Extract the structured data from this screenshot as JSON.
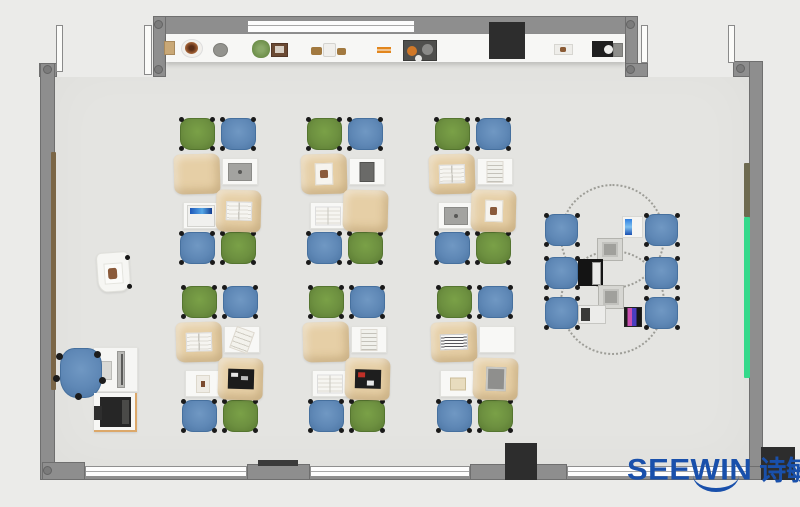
{
  "page": {
    "background": "#ebebe9",
    "width": 800,
    "height": 507
  },
  "logo": {
    "latin": "SEEWIN",
    "cjk": "诗敏",
    "color": "#1950ab"
  },
  "palette": {
    "floor": "#e4e4e1",
    "wall": "#8e8e8e",
    "window": "#fdfdfd",
    "counter": "#f7f7f5",
    "desk_tan": "#e6cfa6",
    "desk_white": "#f8f8f6",
    "chair_green": "#6d9040",
    "chair_blue": "#5f88b6",
    "column_black": "#2d2d2d",
    "board_green": "#35d98b",
    "board_brown": "#7b6647",
    "board_olive": "#6e6a50",
    "logo_blue": "#1950ab"
  },
  "room": {
    "floor": {
      "x": 47,
      "y": 60,
      "w": 706,
      "h": 410
    },
    "outside_patches": [
      {
        "x": 0,
        "y": 0,
        "w": 153,
        "h": 77
      },
      {
        "x": 638,
        "y": 0,
        "w": 162,
        "h": 77
      }
    ],
    "walls": [
      {
        "name": "top-wall",
        "x": 153,
        "y": 16,
        "w": 485,
        "h": 19
      },
      {
        "name": "top-wall-left-post",
        "x": 153,
        "y": 16,
        "w": 13,
        "h": 61
      },
      {
        "name": "top-wall-right-post",
        "x": 625,
        "y": 16,
        "w": 13,
        "h": 61
      },
      {
        "name": "top-right-door-sill",
        "x": 625,
        "y": 63,
        "w": 23,
        "h": 14
      },
      {
        "name": "left-wall-door-stub",
        "x": 39,
        "y": 63,
        "w": 18,
        "h": 14
      },
      {
        "name": "left-wall",
        "x": 40,
        "y": 63,
        "w": 15,
        "h": 417
      },
      {
        "name": "top-right-corner-wall",
        "x": 733,
        "y": 61,
        "w": 30,
        "h": 16
      },
      {
        "name": "right-wall",
        "x": 749,
        "y": 61,
        "w": 14,
        "h": 419
      },
      {
        "name": "bottom-wall",
        "x": 42,
        "y": 466,
        "w": 721,
        "h": 14
      },
      {
        "name": "bottom-left-corner-wall",
        "x": 42,
        "y": 462,
        "w": 43,
        "h": 18
      },
      {
        "name": "bottom-wall-segment-1",
        "x": 247,
        "y": 464,
        "w": 63,
        "h": 16
      },
      {
        "name": "bottom-wall-segment-2",
        "x": 470,
        "y": 464,
        "w": 97,
        "h": 16
      }
    ],
    "corner_dots": [
      [
        47,
        69
      ],
      [
        158,
        24
      ],
      [
        158,
        69
      ],
      [
        630,
        24
      ],
      [
        630,
        69
      ],
      [
        740,
        68
      ],
      [
        47,
        470
      ]
    ],
    "windows": [
      {
        "name": "top-window",
        "x": 247,
        "y": 20,
        "w": 168,
        "h": 13
      },
      {
        "name": "bottom-window-1",
        "x": 85,
        "y": 466,
        "w": 162,
        "h": 11
      },
      {
        "name": "bottom-window-2",
        "x": 310,
        "y": 466,
        "w": 160,
        "h": 11
      },
      {
        "name": "bottom-window-3",
        "x": 567,
        "y": 466,
        "w": 182,
        "h": 11
      }
    ],
    "doors": [
      {
        "name": "door-leaf-top-left-1",
        "x": 56,
        "y": 25,
        "w": 7,
        "h": 47
      },
      {
        "name": "door-leaf-top-left-2",
        "x": 144,
        "y": 25,
        "w": 8,
        "h": 50
      },
      {
        "name": "door-leaf-top-right-1",
        "x": 641,
        "y": 25,
        "w": 7,
        "h": 38
      },
      {
        "name": "door-leaf-top-right-2",
        "x": 728,
        "y": 25,
        "w": 7,
        "h": 38
      }
    ],
    "columns": [
      {
        "name": "pillar-top",
        "x": 489,
        "y": 22,
        "w": 36,
        "h": 37
      },
      {
        "name": "pillar-bottom",
        "x": 505,
        "y": 443,
        "w": 32,
        "h": 37
      },
      {
        "name": "pillar-bottom-right",
        "x": 761,
        "y": 447,
        "w": 34,
        "h": 33
      }
    ],
    "vent_bar": {
      "x": 258,
      "y": 460,
      "w": 40,
      "h": 6
    },
    "boards": [
      {
        "name": "left-wall-board",
        "x": 51,
        "y": 152,
        "w": 5,
        "h": 238,
        "color": "#7b6647"
      },
      {
        "name": "right-wall-board-olive",
        "x": 744,
        "y": 163,
        "w": 6,
        "h": 54,
        "color": "#6e6a50"
      },
      {
        "name": "right-wall-board-green",
        "x": 744,
        "y": 217,
        "w": 6,
        "h": 161,
        "color": "#35d98b"
      }
    ],
    "counter": {
      "x": 166,
      "y": 34,
      "w": 459,
      "h": 28
    },
    "counter_items": [
      {
        "type": "box-tan",
        "name": "decor-box",
        "x": 164,
        "y": 41,
        "w": 11,
        "h": 14
      },
      {
        "type": "plate-pot",
        "name": "decor-pot",
        "x": 181,
        "y": 39,
        "w": 22,
        "h": 19
      },
      {
        "type": "bowl-gray",
        "name": "decor-bowl",
        "x": 213,
        "y": 43,
        "w": 15,
        "h": 14
      },
      {
        "type": "plant-green",
        "name": "decor-plant",
        "x": 252,
        "y": 40,
        "w": 18,
        "h": 18
      },
      {
        "type": "frame-photo",
        "name": "decor-photo-frame",
        "x": 271,
        "y": 43,
        "w": 17,
        "h": 14
      },
      {
        "type": "wood",
        "name": "decor-wood-piece",
        "x": 311,
        "y": 47,
        "w": 11,
        "h": 8
      },
      {
        "type": "bottle",
        "name": "decor-bottle",
        "x": 323,
        "y": 43,
        "w": 13,
        "h": 14
      },
      {
        "type": "wood",
        "name": "decor-wood-piece",
        "x": 337,
        "y": 48,
        "w": 9,
        "h": 7
      },
      {
        "type": "sticks",
        "name": "decor-sticks",
        "x": 377,
        "y": 47,
        "w": 14,
        "h": 6
      },
      {
        "type": "tray-dark",
        "name": "decor-art-tray",
        "x": 403,
        "y": 40,
        "w": 34,
        "h": 21
      },
      {
        "type": "tray-white",
        "name": "decor-small-tray",
        "x": 554,
        "y": 44,
        "w": 19,
        "h": 11
      },
      {
        "type": "device-black",
        "name": "decor-device",
        "x": 592,
        "y": 41,
        "w": 21,
        "h": 16
      },
      {
        "type": "device-gray",
        "name": "decor-device-side",
        "x": 613,
        "y": 43,
        "w": 10,
        "h": 14
      }
    ]
  },
  "teacher_area": {
    "easel": {
      "x": 97,
      "y": 252,
      "w": 33,
      "h": 40
    },
    "desk": {
      "x": 93,
      "y": 347,
      "w": 45,
      "h": 45
    },
    "monitor": {
      "x": 117,
      "y": 351,
      "w": 8,
      "h": 37
    },
    "keyboard": {
      "x": 101,
      "y": 361,
      "w": 11,
      "h": 19
    },
    "chair": {
      "x": 60,
      "y": 348,
      "w": 42,
      "h": 50
    },
    "printer_stand": {
      "x": 94,
      "y": 393,
      "w": 43,
      "h": 39
    },
    "printer": {
      "x": 100,
      "y": 397,
      "w": 31,
      "h": 30
    }
  },
  "desk_clusters": {
    "origins": [
      [
        174,
        118
      ],
      [
        301,
        118
      ],
      [
        429,
        118
      ],
      [
        176,
        286
      ],
      [
        303,
        286
      ],
      [
        431,
        286
      ]
    ],
    "chair_layout": [
      {
        "pos": [
          6,
          0
        ],
        "color": "green"
      },
      {
        "pos": [
          47,
          0
        ],
        "color": "blue"
      },
      {
        "pos": [
          6,
          114
        ],
        "color": "blue"
      },
      {
        "pos": [
          47,
          114
        ],
        "color": "green"
      }
    ],
    "chair_size": [
      35,
      32
    ],
    "desk_layout": [
      {
        "pos": [
          0,
          36
        ],
        "size": [
          46,
          40
        ],
        "kind": "tan"
      },
      {
        "pos": [
          48,
          40
        ],
        "size": [
          36,
          27
        ],
        "kind": "white"
      },
      {
        "pos": [
          9,
          84
        ],
        "size": [
          36,
          27
        ],
        "kind": "white"
      },
      {
        "pos": [
          42,
          72
        ],
        "size": [
          45,
          42
        ],
        "kind": "tan"
      }
    ],
    "items": [
      [
        "none",
        "laptop-gray",
        "screen-blue",
        "book-open"
      ],
      [
        "paper-photo",
        "tablet-dark",
        "book-open",
        "none"
      ],
      [
        "book-open",
        "paper-lines",
        "laptop-gray",
        "paper-photo"
      ],
      [
        "book-open",
        "paper-tilt",
        "photo-small",
        "laptop-black"
      ],
      [
        "none",
        "paper-lines",
        "book-open",
        "laptop-black-red"
      ],
      [
        "keyboard-white",
        "none",
        "card-beige",
        "frame-gray"
      ]
    ]
  },
  "collab_area": {
    "circles": [
      {
        "x": 560,
        "y": 184,
        "d": 105
      },
      {
        "x": 560,
        "y": 250,
        "d": 105
      }
    ],
    "chairs": [
      [
        545,
        214
      ],
      [
        545,
        257
      ],
      [
        545,
        297
      ],
      [
        645,
        214
      ],
      [
        645,
        257
      ],
      [
        645,
        297
      ]
    ],
    "chair_size": [
      33,
      32
    ],
    "devices": [
      {
        "type": "tablet-blue",
        "name": "collab-tablet-blue",
        "x": 622,
        "y": 216,
        "w": 21,
        "h": 22
      },
      {
        "type": "box-gray",
        "name": "collab-device-box",
        "x": 597,
        "y": 238,
        "w": 26,
        "h": 23
      },
      {
        "type": "laptop-black2",
        "name": "collab-laptop-black",
        "x": 578,
        "y": 259,
        "w": 25,
        "h": 27
      },
      {
        "type": "box-gray",
        "name": "collab-device-box",
        "x": 598,
        "y": 285,
        "w": 26,
        "h": 24
      },
      {
        "type": "laptop-white",
        "name": "collab-laptop-white",
        "x": 578,
        "y": 305,
        "w": 28,
        "h": 19
      },
      {
        "type": "tablet-pink",
        "name": "collab-tablet-pink",
        "x": 624,
        "y": 307,
        "w": 18,
        "h": 20
      }
    ]
  }
}
